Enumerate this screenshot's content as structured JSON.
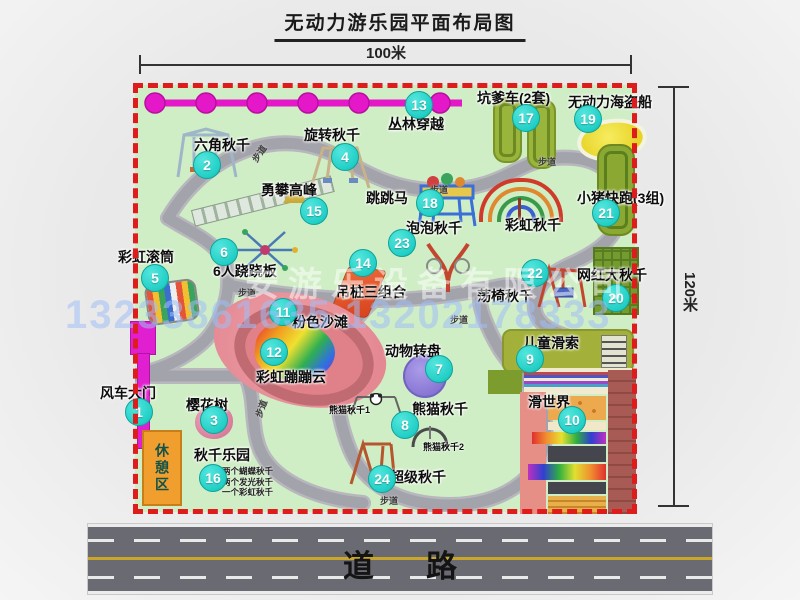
{
  "title": "无动力游乐园平面布局图",
  "dimensions": {
    "width": "100米",
    "height": "120米"
  },
  "road": {
    "label": "道路"
  },
  "watermark": {
    "company": "安游乐设备有限公司",
    "phone": "13233861635 13202178333"
  },
  "walkway_label": "步道",
  "attractions": [
    {
      "num": "1",
      "name": "风车大门"
    },
    {
      "num": "2",
      "name": "六角秋千"
    },
    {
      "num": "3",
      "name": "樱花树"
    },
    {
      "num": "4",
      "name": "旋转秋千"
    },
    {
      "num": "5",
      "name": "彩虹滚筒"
    },
    {
      "num": "6",
      "name": "6人跷跷板"
    },
    {
      "num": "7",
      "name": "动物转盘"
    },
    {
      "num": "8",
      "name": "熊猫秋千"
    },
    {
      "num": "9",
      "name": "儿童滑索"
    },
    {
      "num": "10",
      "name": "滑世界"
    },
    {
      "num": "11",
      "name": "粉色沙滩"
    },
    {
      "num": "12",
      "name": "彩虹蹦蹦云"
    },
    {
      "num": "13",
      "name": "丛林穿越"
    },
    {
      "num": "14",
      "name": "吊桩三组合"
    },
    {
      "num": "15",
      "name": "勇攀高峰"
    },
    {
      "num": "16",
      "name": "秋千乐园"
    },
    {
      "num": "17",
      "name": "坑爹车(2套)"
    },
    {
      "num": "18",
      "name": "跳跳马"
    },
    {
      "num": "19",
      "name": "无动力海盗船"
    },
    {
      "num": "20",
      "name": "网红大秋千"
    },
    {
      "num": "21",
      "name": "小猪快跑(3组)"
    },
    {
      "num": "22",
      "name": "荡椅秋千"
    },
    {
      "num": "23",
      "name": "泡泡秋千"
    },
    {
      "num": "24",
      "name": "超级秋千"
    }
  ],
  "extra_labels": {
    "rainbow_swing": "彩虹秋千",
    "rest_area": "休憩区",
    "panda_swing_1": "熊猫秋千1",
    "panda_swing_2": "熊猫秋千2",
    "swing_park_notes": [
      "两个蝴蝶秋千",
      "两个发光秋千",
      "一个彩虹秋千"
    ]
  },
  "colors": {
    "map_green": "#cfeec5",
    "border_red": "#de1c1c",
    "badge_cyan": "#22cfc6",
    "jungle_magenta": "#e417c9",
    "road_gray": "#6a6a72"
  }
}
